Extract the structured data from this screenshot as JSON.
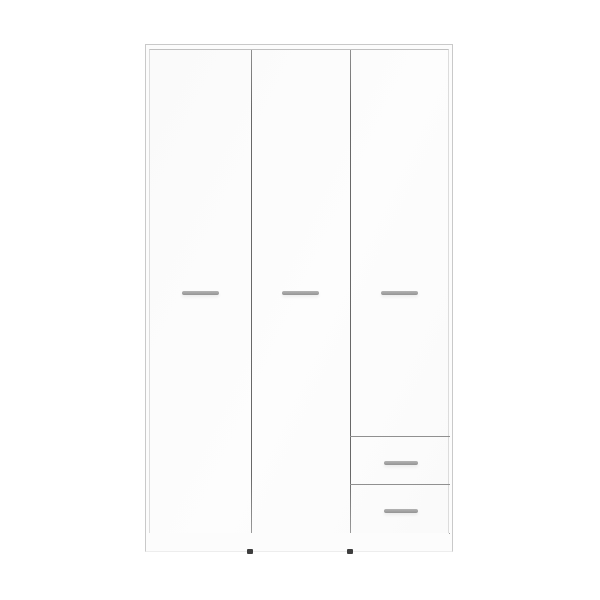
{
  "colors": {
    "background": "#ffffff",
    "body": "#fcfcfc",
    "edge": "#c9c9c9",
    "edge-bottom": "#ededed",
    "door-frame": "#dcdcdc",
    "door-top-edge": "#c0c0c0",
    "door-face": "#fafafa",
    "door-face-hi": "#fdfdfd",
    "seam": "#686868",
    "bottom-seam": "#a3a3a3",
    "drawer-seam": "#909090",
    "handle-light": "#b3b3b3",
    "handle-dark": "#949494",
    "foot": "#3e3e3e"
  },
  "product": {
    "kind": "wardrobe",
    "finish": "white",
    "doors": 3,
    "drawers": 2,
    "door_handles": 3,
    "drawer_handles": 2,
    "feet_visible": 2
  }
}
